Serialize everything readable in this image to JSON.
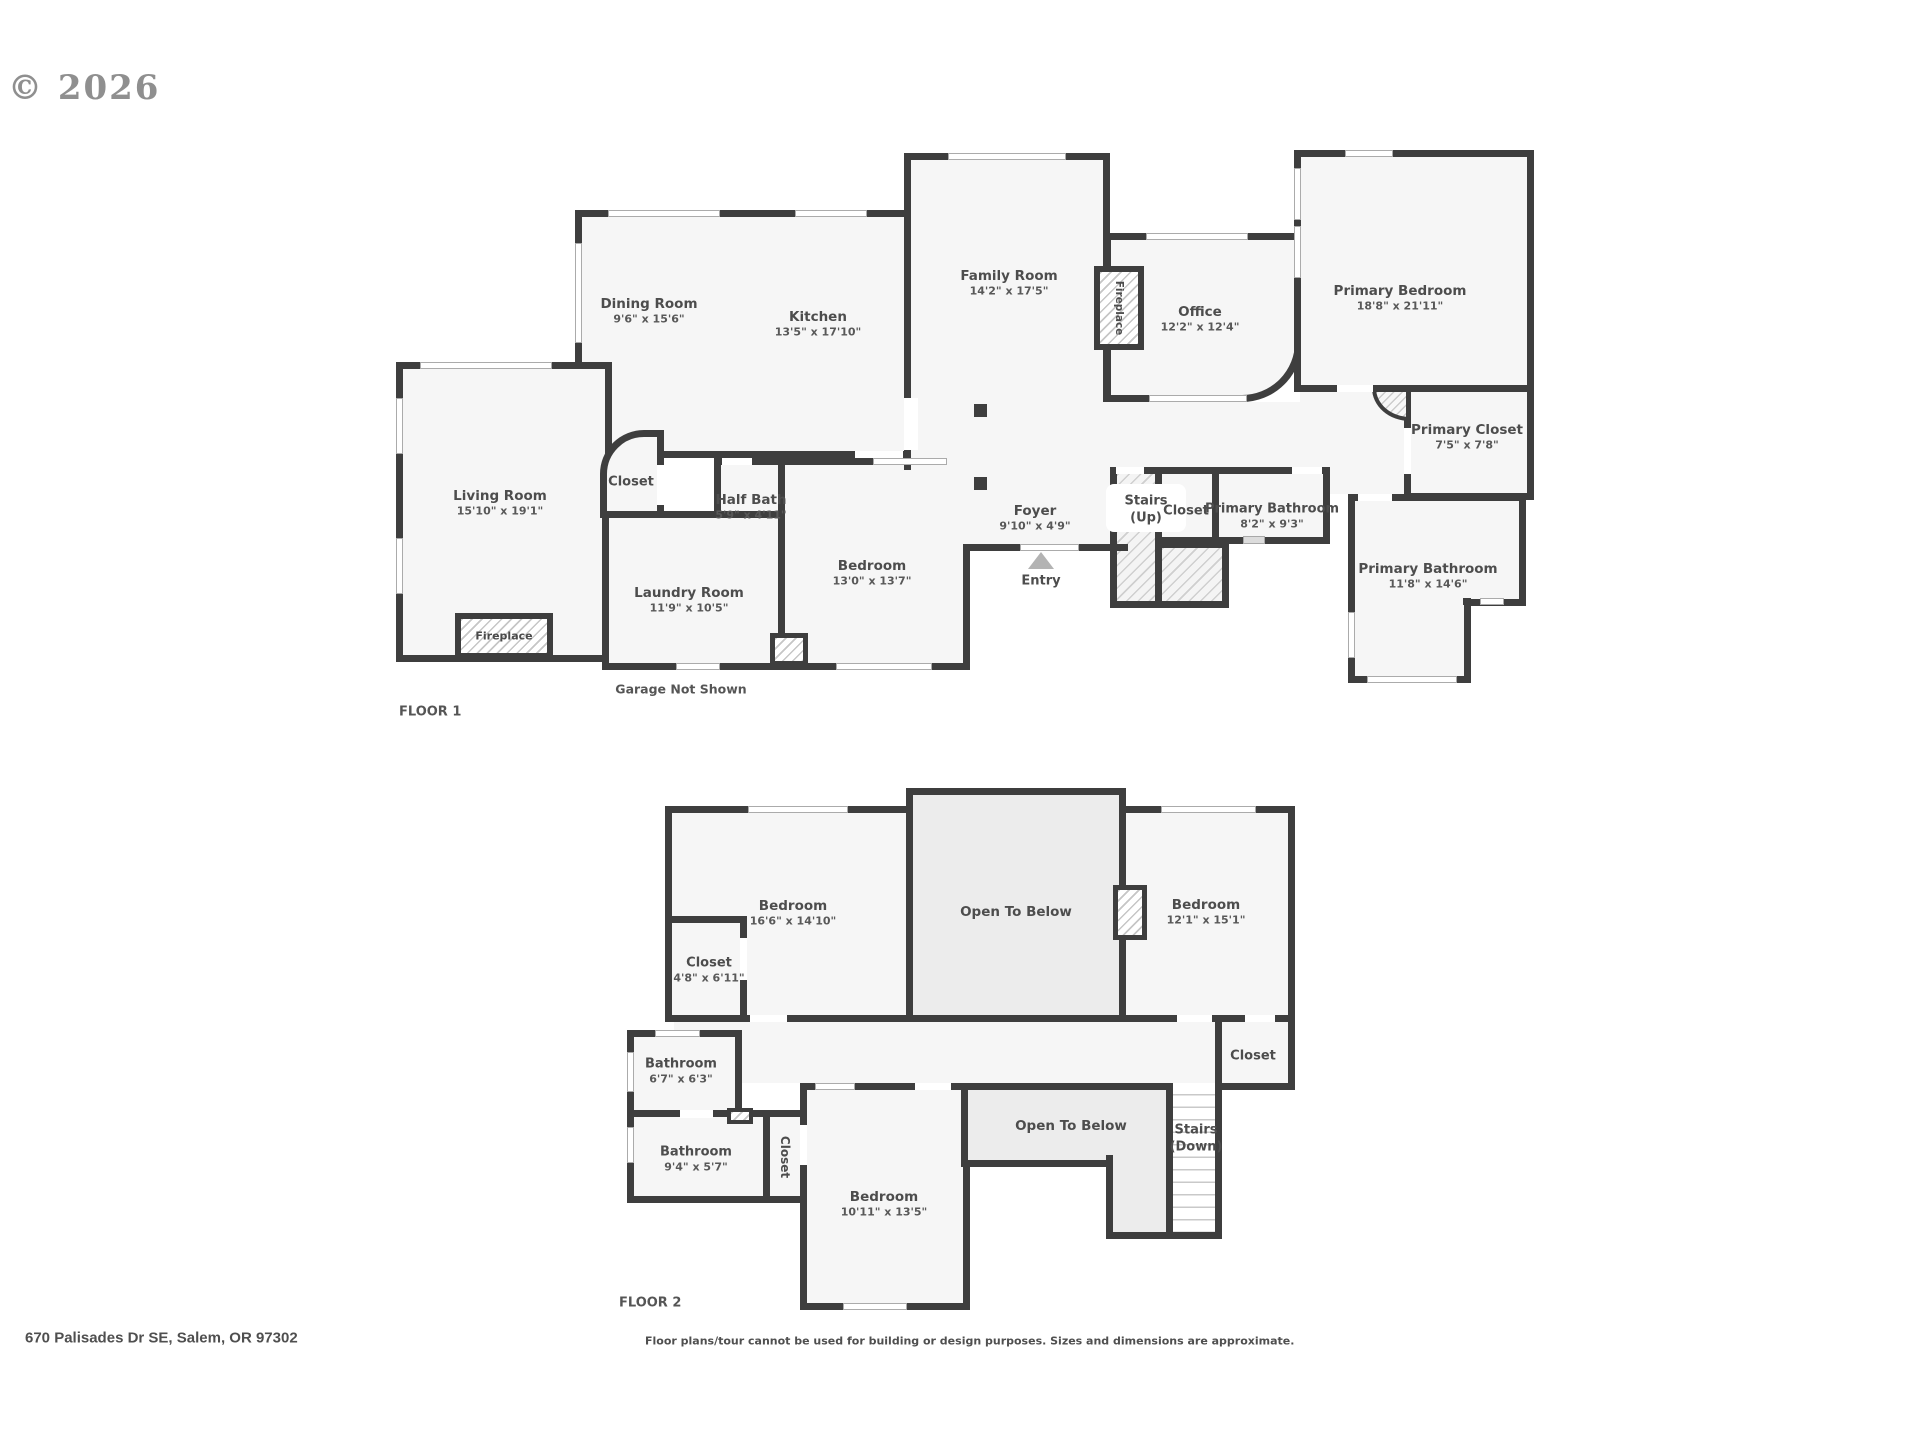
{
  "watermark": "© 2026",
  "footer": {
    "address": "670 Palisades Dr SE, Salem, OR 97302",
    "disclaimer": "Floor plans/tour cannot be used for building or design purposes. Sizes and dimensions are approximate."
  },
  "floor1": {
    "title": "FLOOR 1",
    "note": "Garage Not Shown",
    "entry": "Entry",
    "fireplace": "Fireplace",
    "rooms": [
      {
        "name": "Dining Room",
        "dims": "9'6\" x 15'6\""
      },
      {
        "name": "Kitchen",
        "dims": "13'5\" x 17'10\""
      },
      {
        "name": "Family Room",
        "dims": "14'2\" x 17'5\""
      },
      {
        "name": "Office",
        "dims": "12'2\" x 12'4\""
      },
      {
        "name": "Primary Bedroom",
        "dims": "18'8\" x 21'11\""
      },
      {
        "name": "Primary Closet",
        "dims": "7'5\" x 7'8\""
      },
      {
        "name": "Living Room",
        "dims": "15'10\" x 19'1\""
      },
      {
        "name": "Closet",
        "dims": ""
      },
      {
        "name": "Half Bath",
        "dims": "5'9\" x 4'11\""
      },
      {
        "name": "Laundry Room",
        "dims": "11'9\" x 10'5\""
      },
      {
        "name": "Bedroom",
        "dims": "13'0\" x 13'7\""
      },
      {
        "name": "Foyer",
        "dims": "9'10\" x 4'9\""
      },
      {
        "name": "Stairs",
        "dims": "(Up)"
      },
      {
        "name": "Closet",
        "dims": ""
      },
      {
        "name": "Primary Bathroom",
        "dims": "8'2\" x 9'3\""
      },
      {
        "name": "Primary Bathroom",
        "dims": "11'8\" x 14'6\""
      }
    ]
  },
  "floor2": {
    "title": "FLOOR 2",
    "rooms": [
      {
        "name": "Bedroom",
        "dims": "16'6\" x 14'10\""
      },
      {
        "name": "Closet",
        "dims": "4'8\" x 6'11\""
      },
      {
        "name": "Open To Below",
        "dims": ""
      },
      {
        "name": "Bedroom",
        "dims": "12'1\" x 15'1\""
      },
      {
        "name": "Bathroom",
        "dims": "6'7\" x 6'3\""
      },
      {
        "name": "Closet",
        "dims": ""
      },
      {
        "name": "Bathroom",
        "dims": "9'4\" x 5'7\""
      },
      {
        "name": "Closet",
        "dims": ""
      },
      {
        "name": "Bedroom",
        "dims": "10'11\" x 13'5\""
      },
      {
        "name": "Open To Below",
        "dims": ""
      },
      {
        "name": "Stairs",
        "dims": "(Down)"
      }
    ]
  }
}
